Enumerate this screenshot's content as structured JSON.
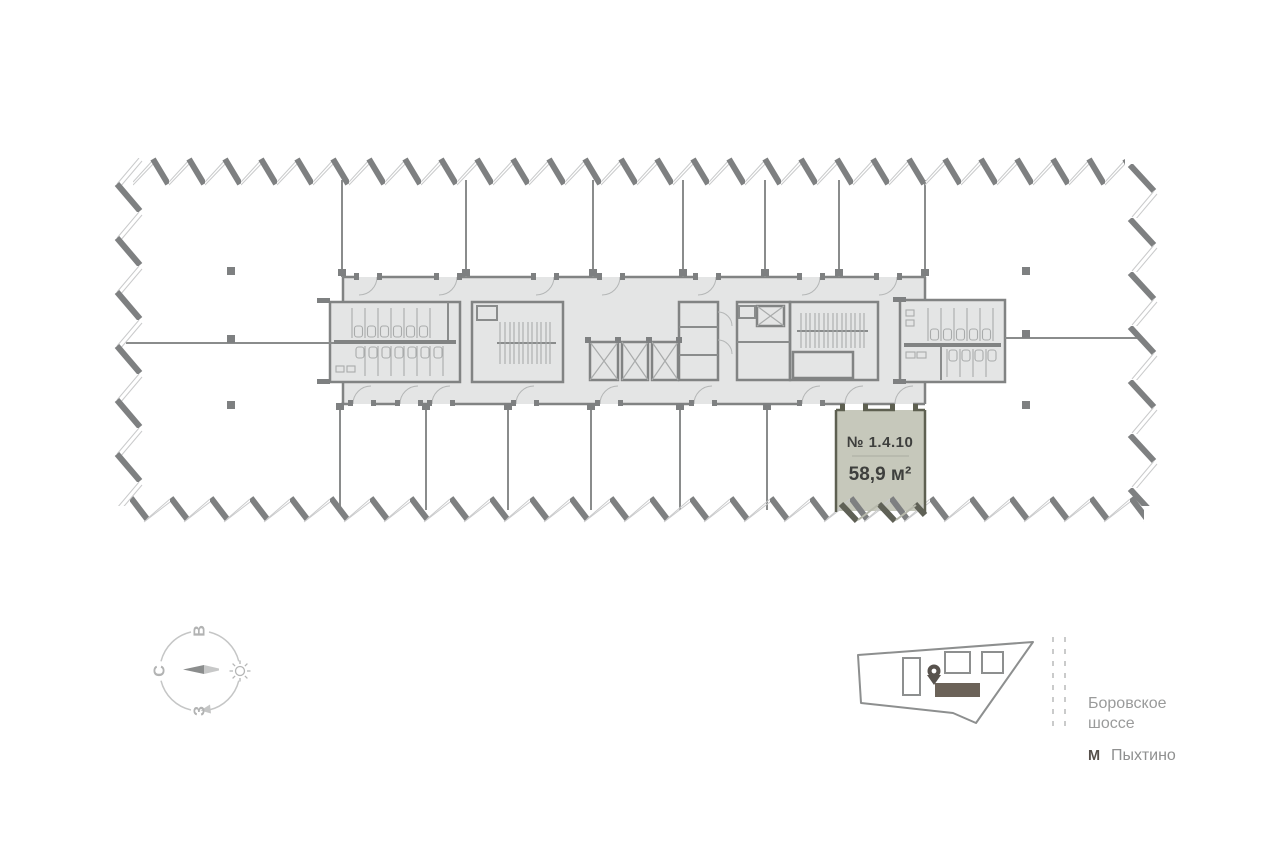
{
  "floor_plan": {
    "unit": {
      "number": "№ 1.4.10",
      "area": "58,9 м²",
      "fill_color": "#c6c8bb",
      "border_color": "#5e6051"
    },
    "compass": {
      "north": "С",
      "east": "В",
      "west": "З"
    },
    "legend": {
      "road_line1": "Боровское",
      "road_line2": "шоссе",
      "metro_mark": "М",
      "metro_name": "Пыхтино"
    },
    "colors": {
      "core_fill": "#e4e5e5",
      "wall": "#818383",
      "facade_dark": "#7e8081",
      "facade_light": "#c9cacb",
      "text_dark": "#3e3f3d",
      "text_gray": "#9a9b9b"
    }
  }
}
